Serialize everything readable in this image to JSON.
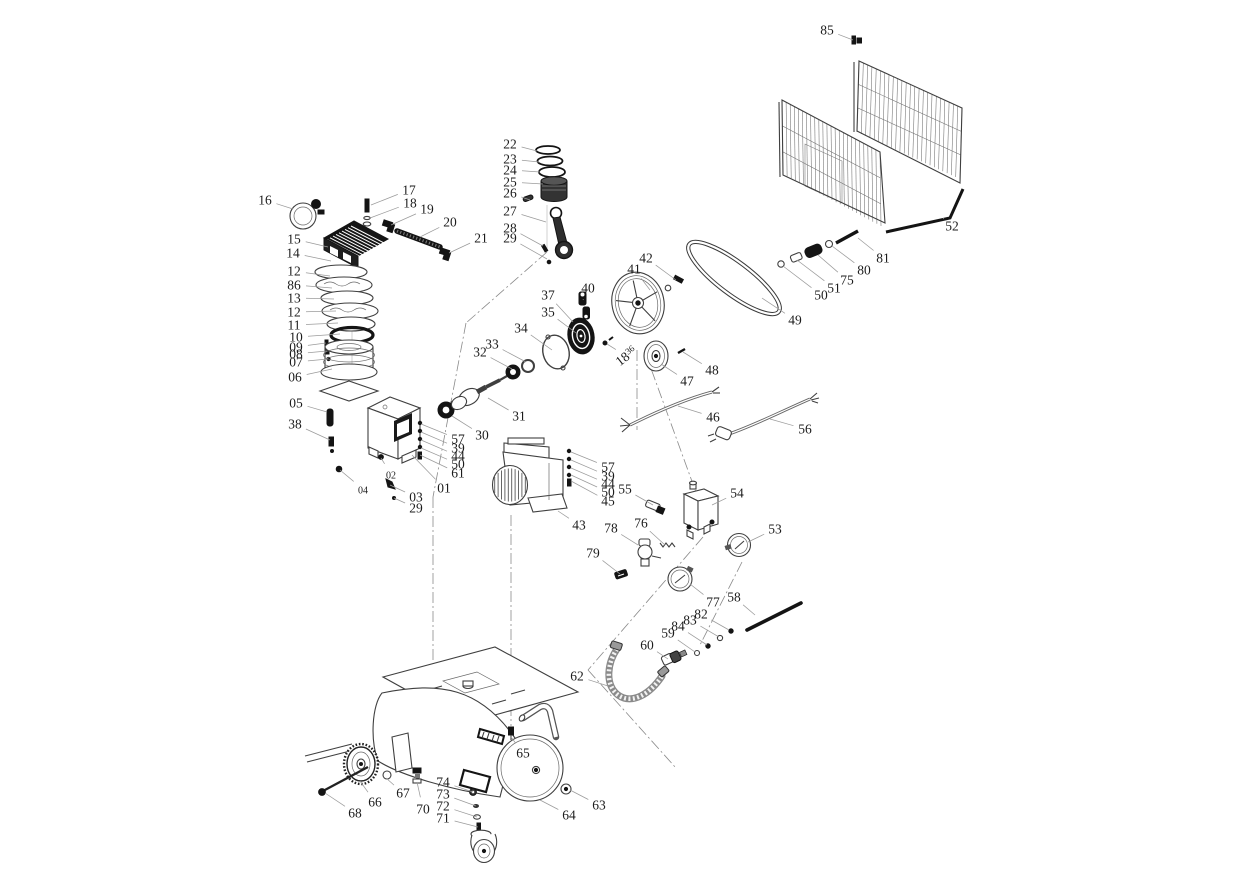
{
  "meta": {
    "title": "air-compressor-exploded-parts-diagram",
    "background": "#ffffff",
    "stroke_color": "#3f3f3f",
    "leader_color": "#9b9b9b",
    "label_color": "#1c1c1c"
  },
  "labels": [
    {
      "t": "85",
      "x": 827,
      "y": 30,
      "ex": 853,
      "ey": 40
    },
    {
      "t": "52",
      "x": 952,
      "y": 226,
      "ex": 944,
      "ey": 219
    },
    {
      "t": "81",
      "x": 883,
      "y": 258,
      "ex": 858,
      "ey": 238
    },
    {
      "t": "80",
      "x": 864,
      "y": 270,
      "ex": 832,
      "ey": 246
    },
    {
      "t": "75",
      "x": 847,
      "y": 280,
      "ex": 818,
      "ey": 255
    },
    {
      "t": "51",
      "x": 834,
      "y": 288,
      "ex": 797,
      "ey": 260
    },
    {
      "t": "50",
      "x": 821,
      "y": 295,
      "ex": 783,
      "ey": 266
    },
    {
      "t": "49",
      "x": 795,
      "y": 320,
      "ex": 762,
      "ey": 298
    },
    {
      "t": "42",
      "x": 646,
      "y": 258,
      "ex": 676,
      "ey": 280
    },
    {
      "t": "41",
      "x": 634,
      "y": 269,
      "ex": 650,
      "ey": 290
    },
    {
      "t": "40",
      "x": 588,
      "y": 288,
      "ex": 583,
      "ey": 300
    },
    {
      "t": "37",
      "x": 548,
      "y": 295,
      "ex": 573,
      "ey": 322
    },
    {
      "t": "35",
      "x": 548,
      "y": 312,
      "ex": 576,
      "ey": 333
    },
    {
      "t": "34",
      "x": 521,
      "y": 328,
      "ex": 552,
      "ey": 350
    },
    {
      "t": "33",
      "x": 492,
      "y": 344,
      "ex": 526,
      "ey": 362
    },
    {
      "t": "32",
      "x": 480,
      "y": 352,
      "ex": 512,
      "ey": 369
    },
    {
      "t": "31",
      "x": 519,
      "y": 416,
      "ex": 488,
      "ey": 398
    },
    {
      "t": "30",
      "x": 482,
      "y": 435,
      "ex": 452,
      "ey": 416
    },
    {
      "t": "48",
      "x": 712,
      "y": 370,
      "ex": 683,
      "ey": 352
    },
    {
      "t": "47",
      "x": 687,
      "y": 381,
      "ex": 661,
      "ey": 364
    },
    {
      "t": "46",
      "x": 713,
      "y": 417,
      "ex": 678,
      "ey": 406
    },
    {
      "t": "56",
      "x": 805,
      "y": 429,
      "ex": 770,
      "ey": 419
    },
    {
      "t": "18",
      "sup": "36",
      "x": 626,
      "y": 356,
      "rot": -38,
      "ex": 607,
      "ey": 344
    },
    {
      "t": "22",
      "x": 510,
      "y": 144,
      "ex": 537,
      "ey": 151
    },
    {
      "t": "23",
      "x": 510,
      "y": 159,
      "ex": 539,
      "ey": 162
    },
    {
      "t": "24",
      "x": 510,
      "y": 170,
      "ex": 540,
      "ey": 172
    },
    {
      "t": "25",
      "x": 510,
      "y": 182,
      "ex": 543,
      "ey": 184
    },
    {
      "t": "26",
      "x": 510,
      "y": 193,
      "ex": 530,
      "ey": 200
    },
    {
      "t": "27",
      "x": 510,
      "y": 211,
      "ex": 546,
      "ey": 222
    },
    {
      "t": "28",
      "x": 510,
      "y": 228,
      "ex": 543,
      "ey": 246
    },
    {
      "t": "29",
      "x": 510,
      "y": 238,
      "ex": 547,
      "ey": 259
    },
    {
      "t": "17",
      "x": 409,
      "y": 190,
      "ex": 371,
      "ey": 205
    },
    {
      "t": "18",
      "x": 410,
      "y": 203,
      "ex": 370,
      "ey": 218
    },
    {
      "t": "19",
      "x": 427,
      "y": 209,
      "ex": 391,
      "ey": 225
    },
    {
      "t": "20",
      "x": 450,
      "y": 222,
      "ex": 420,
      "ey": 237
    },
    {
      "t": "21",
      "x": 481,
      "y": 238,
      "ex": 449,
      "ey": 253
    },
    {
      "t": "16",
      "x": 265,
      "y": 200,
      "ex": 293,
      "ey": 209
    },
    {
      "t": "15",
      "x": 294,
      "y": 239,
      "ex": 328,
      "ey": 247
    },
    {
      "t": "14",
      "x": 293,
      "y": 253,
      "ex": 331,
      "ey": 261
    },
    {
      "t": "12",
      "x": 294,
      "y": 271,
      "ex": 330,
      "ey": 276
    },
    {
      "t": "86",
      "x": 294,
      "y": 285,
      "ex": 332,
      "ey": 288
    },
    {
      "t": "13",
      "x": 294,
      "y": 298,
      "ex": 334,
      "ey": 299
    },
    {
      "t": "12",
      "x": 294,
      "y": 312,
      "ex": 336,
      "ey": 311
    },
    {
      "t": "11",
      "x": 294,
      "y": 325,
      "ex": 338,
      "ey": 323
    },
    {
      "t": "10",
      "x": 296,
      "y": 337,
      "ex": 340,
      "ey": 334
    },
    {
      "t": "09",
      "x": 296,
      "y": 347,
      "ex": 326,
      "ey": 343
    },
    {
      "t": "08",
      "x": 296,
      "y": 354,
      "ex": 327,
      "ey": 351
    },
    {
      "t": "07",
      "x": 296,
      "y": 362,
      "ex": 328,
      "ey": 359
    },
    {
      "t": "06",
      "x": 295,
      "y": 377,
      "ex": 332,
      "ey": 369
    },
    {
      "t": "05",
      "x": 296,
      "y": 403,
      "ex": 327,
      "ey": 412
    },
    {
      "t": "38",
      "x": 295,
      "y": 424,
      "ex": 330,
      "ey": 440
    },
    {
      "t": "57",
      "x": 458,
      "y": 439,
      "ex": 421,
      "ey": 424
    },
    {
      "t": "39",
      "x": 458,
      "y": 448,
      "ex": 421,
      "ey": 432
    },
    {
      "t": "44",
      "x": 458,
      "y": 456,
      "ex": 421,
      "ey": 440
    },
    {
      "t": "50",
      "x": 458,
      "y": 464,
      "ex": 421,
      "ey": 448
    },
    {
      "t": "61",
      "x": 458,
      "y": 473,
      "ex": 420,
      "ey": 455
    },
    {
      "t": "01",
      "x": 444,
      "y": 488,
      "ex": 412,
      "ey": 455
    },
    {
      "t": "02",
      "x": 391,
      "y": 474,
      "s": 1,
      "ex": 381,
      "ey": 458
    },
    {
      "t": "04",
      "x": 363,
      "y": 489,
      "s": 1,
      "ex": 340,
      "ey": 470
    },
    {
      "t": "03",
      "x": 416,
      "y": 497,
      "ex": 390,
      "ey": 485
    },
    {
      "t": "29",
      "x": 416,
      "y": 508,
      "ex": 394,
      "ey": 498
    },
    {
      "t": "57",
      "x": 608,
      "y": 467,
      "ex": 571,
      "ey": 452
    },
    {
      "t": "39",
      "x": 608,
      "y": 476,
      "ex": 571,
      "ey": 460
    },
    {
      "t": "44",
      "x": 608,
      "y": 484,
      "ex": 571,
      "ey": 468
    },
    {
      "t": "50",
      "x": 608,
      "y": 492,
      "ex": 571,
      "ey": 475
    },
    {
      "t": "45",
      "x": 608,
      "y": 501,
      "ex": 571,
      "ey": 481
    },
    {
      "t": "55",
      "x": 625,
      "y": 489,
      "ex": 653,
      "ey": 505
    },
    {
      "t": "43",
      "x": 579,
      "y": 525,
      "ex": 558,
      "ey": 511
    },
    {
      "t": "78",
      "x": 611,
      "y": 528,
      "ex": 638,
      "ey": 545
    },
    {
      "t": "76",
      "x": 641,
      "y": 523,
      "ex": 665,
      "ey": 545
    },
    {
      "t": "79",
      "x": 593,
      "y": 553,
      "ex": 620,
      "ey": 574
    },
    {
      "t": "54",
      "x": 737,
      "y": 493,
      "ex": 712,
      "ey": 505
    },
    {
      "t": "53",
      "x": 775,
      "y": 529,
      "ex": 748,
      "ey": 542
    },
    {
      "t": "77",
      "x": 713,
      "y": 602,
      "ex": 690,
      "ey": 584
    },
    {
      "t": "58",
      "x": 734,
      "y": 597,
      "ex": 755,
      "ey": 615
    },
    {
      "t": "82",
      "x": 701,
      "y": 614,
      "ex": 729,
      "ey": 630
    },
    {
      "t": "83",
      "x": 690,
      "y": 620,
      "ex": 719,
      "ey": 637
    },
    {
      "t": "84",
      "x": 678,
      "y": 626,
      "ex": 707,
      "ey": 645
    },
    {
      "t": "59",
      "x": 668,
      "y": 633,
      "ex": 695,
      "ey": 652
    },
    {
      "t": "60",
      "x": 647,
      "y": 645,
      "ex": 668,
      "ey": 659
    },
    {
      "t": "62",
      "x": 577,
      "y": 676,
      "ex": 608,
      "ey": 686
    },
    {
      "t": "65",
      "x": 523,
      "y": 753,
      "ex": 511,
      "ey": 737
    },
    {
      "t": "66",
      "x": 375,
      "y": 802,
      "ex": 360,
      "ey": 781
    },
    {
      "t": "67",
      "x": 403,
      "y": 793,
      "ex": 386,
      "ey": 778
    },
    {
      "t": "68",
      "x": 355,
      "y": 813,
      "ex": 325,
      "ey": 793
    },
    {
      "t": "70",
      "x": 423,
      "y": 809,
      "ex": 417,
      "ey": 782
    },
    {
      "t": "74",
      "x": 443,
      "y": 782,
      "ex": 473,
      "ey": 792
    },
    {
      "t": "73",
      "x": 443,
      "y": 794,
      "ex": 476,
      "ey": 806
    },
    {
      "t": "72",
      "x": 443,
      "y": 806,
      "ex": 477,
      "ey": 817
    },
    {
      "t": "71",
      "x": 443,
      "y": 818,
      "ex": 478,
      "ey": 827
    },
    {
      "t": "63",
      "x": 599,
      "y": 805,
      "ex": 570,
      "ey": 790
    },
    {
      "t": "64",
      "x": 569,
      "y": 815,
      "ex": 540,
      "ey": 800
    }
  ]
}
